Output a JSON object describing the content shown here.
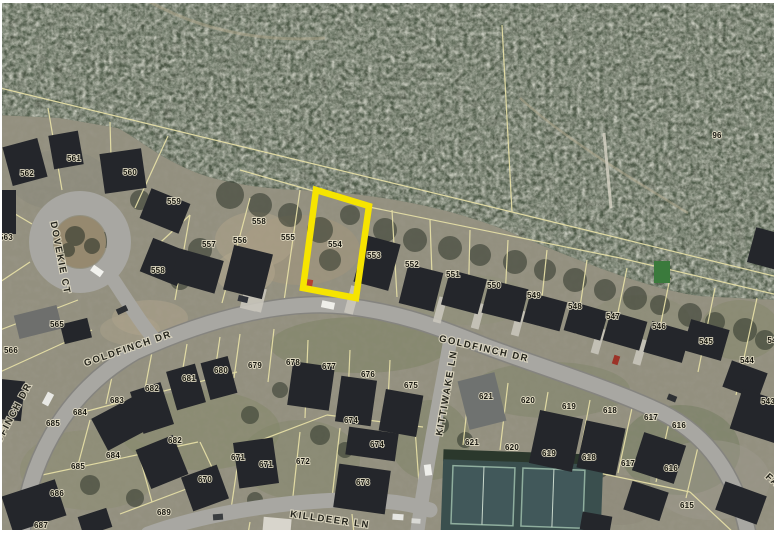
{
  "map": {
    "type": "aerial-parcel-map",
    "highlighted_parcel": "554",
    "colors": {
      "highlight": "#f6e400",
      "parcel_line": "#e6dfa6",
      "road": "#a8a7a2",
      "forest": "#4b5244",
      "ground": "#93907f"
    }
  },
  "street_labels": [
    {
      "text": "GOLDFINCH DR",
      "x": 128,
      "y": 349,
      "rot": -19
    },
    {
      "text": "GOLDFINCH DR",
      "x": 484,
      "y": 349,
      "rot": 13
    },
    {
      "text": "GOLDFINCH DR",
      "x": 8,
      "y": 424,
      "rot": -62
    },
    {
      "text": "DOVEKIE CT",
      "x": 60,
      "y": 258,
      "rot": 79
    },
    {
      "text": "KITTIWAKE LN",
      "x": 447,
      "y": 393,
      "rot": -80
    },
    {
      "text": "KILLDEER LN",
      "x": 330,
      "y": 520,
      "rot": 8
    },
    {
      "text": "FAI",
      "x": 774,
      "y": 482,
      "rot": 42
    }
  ],
  "parcel_labels": [
    {
      "text": "96",
      "x": 717,
      "y": 136
    },
    {
      "text": "562",
      "x": 27,
      "y": 174
    },
    {
      "text": "561",
      "x": 74,
      "y": 159
    },
    {
      "text": "560",
      "x": 130,
      "y": 173
    },
    {
      "text": "559",
      "x": 174,
      "y": 202
    },
    {
      "text": "563",
      "x": 6,
      "y": 238
    },
    {
      "text": "558",
      "x": 259,
      "y": 222
    },
    {
      "text": "557",
      "x": 209,
      "y": 245
    },
    {
      "text": "556",
      "x": 240,
      "y": 241
    },
    {
      "text": "555",
      "x": 288,
      "y": 238
    },
    {
      "text": "554",
      "x": 335,
      "y": 245
    },
    {
      "text": "558",
      "x": 158,
      "y": 271
    },
    {
      "text": "553",
      "x": 374,
      "y": 256
    },
    {
      "text": "552",
      "x": 412,
      "y": 265
    },
    {
      "text": "551",
      "x": 453,
      "y": 275
    },
    {
      "text": "550",
      "x": 494,
      "y": 286
    },
    {
      "text": "549",
      "x": 534,
      "y": 296
    },
    {
      "text": "548",
      "x": 575,
      "y": 307
    },
    {
      "text": "547",
      "x": 613,
      "y": 317
    },
    {
      "text": "546",
      "x": 659,
      "y": 327
    },
    {
      "text": "545",
      "x": 706,
      "y": 342
    },
    {
      "text": "54",
      "x": 772,
      "y": 341
    },
    {
      "text": "544",
      "x": 747,
      "y": 361
    },
    {
      "text": "543",
      "x": 768,
      "y": 402
    },
    {
      "text": "565",
      "x": 57,
      "y": 325
    },
    {
      "text": "566",
      "x": 11,
      "y": 351
    },
    {
      "text": "679",
      "x": 255,
      "y": 366
    },
    {
      "text": "678",
      "x": 293,
      "y": 363
    },
    {
      "text": "677",
      "x": 329,
      "y": 367
    },
    {
      "text": "676",
      "x": 368,
      "y": 375
    },
    {
      "text": "675",
      "x": 411,
      "y": 386
    },
    {
      "text": "680",
      "x": 221,
      "y": 371
    },
    {
      "text": "681",
      "x": 189,
      "y": 379
    },
    {
      "text": "682",
      "x": 152,
      "y": 389
    },
    {
      "text": "683",
      "x": 117,
      "y": 401
    },
    {
      "text": "684",
      "x": 80,
      "y": 413
    },
    {
      "text": "685",
      "x": 53,
      "y": 424
    },
    {
      "text": "682",
      "x": 175,
      "y": 441
    },
    {
      "text": "684",
      "x": 113,
      "y": 456
    },
    {
      "text": "685",
      "x": 78,
      "y": 467
    },
    {
      "text": "686",
      "x": 57,
      "y": 494
    },
    {
      "text": "687",
      "x": 41,
      "y": 526
    },
    {
      "text": "689",
      "x": 164,
      "y": 513
    },
    {
      "text": "670",
      "x": 205,
      "y": 480
    },
    {
      "text": "671",
      "x": 238,
      "y": 458
    },
    {
      "text": "671",
      "x": 266,
      "y": 465
    },
    {
      "text": "672",
      "x": 303,
      "y": 462
    },
    {
      "text": "673",
      "x": 363,
      "y": 483
    },
    {
      "text": "674",
      "x": 351,
      "y": 421
    },
    {
      "text": "674",
      "x": 377,
      "y": 445
    },
    {
      "text": "621",
      "x": 486,
      "y": 397
    },
    {
      "text": "620",
      "x": 528,
      "y": 401
    },
    {
      "text": "619",
      "x": 569,
      "y": 407
    },
    {
      "text": "618",
      "x": 610,
      "y": 411
    },
    {
      "text": "617",
      "x": 651,
      "y": 418
    },
    {
      "text": "616",
      "x": 679,
      "y": 426
    },
    {
      "text": "621",
      "x": 472,
      "y": 443
    },
    {
      "text": "620",
      "x": 512,
      "y": 448
    },
    {
      "text": "619",
      "x": 549,
      "y": 454
    },
    {
      "text": "618",
      "x": 589,
      "y": 458
    },
    {
      "text": "617",
      "x": 628,
      "y": 464
    },
    {
      "text": "616",
      "x": 671,
      "y": 469
    },
    {
      "text": "615",
      "x": 687,
      "y": 506
    }
  ]
}
